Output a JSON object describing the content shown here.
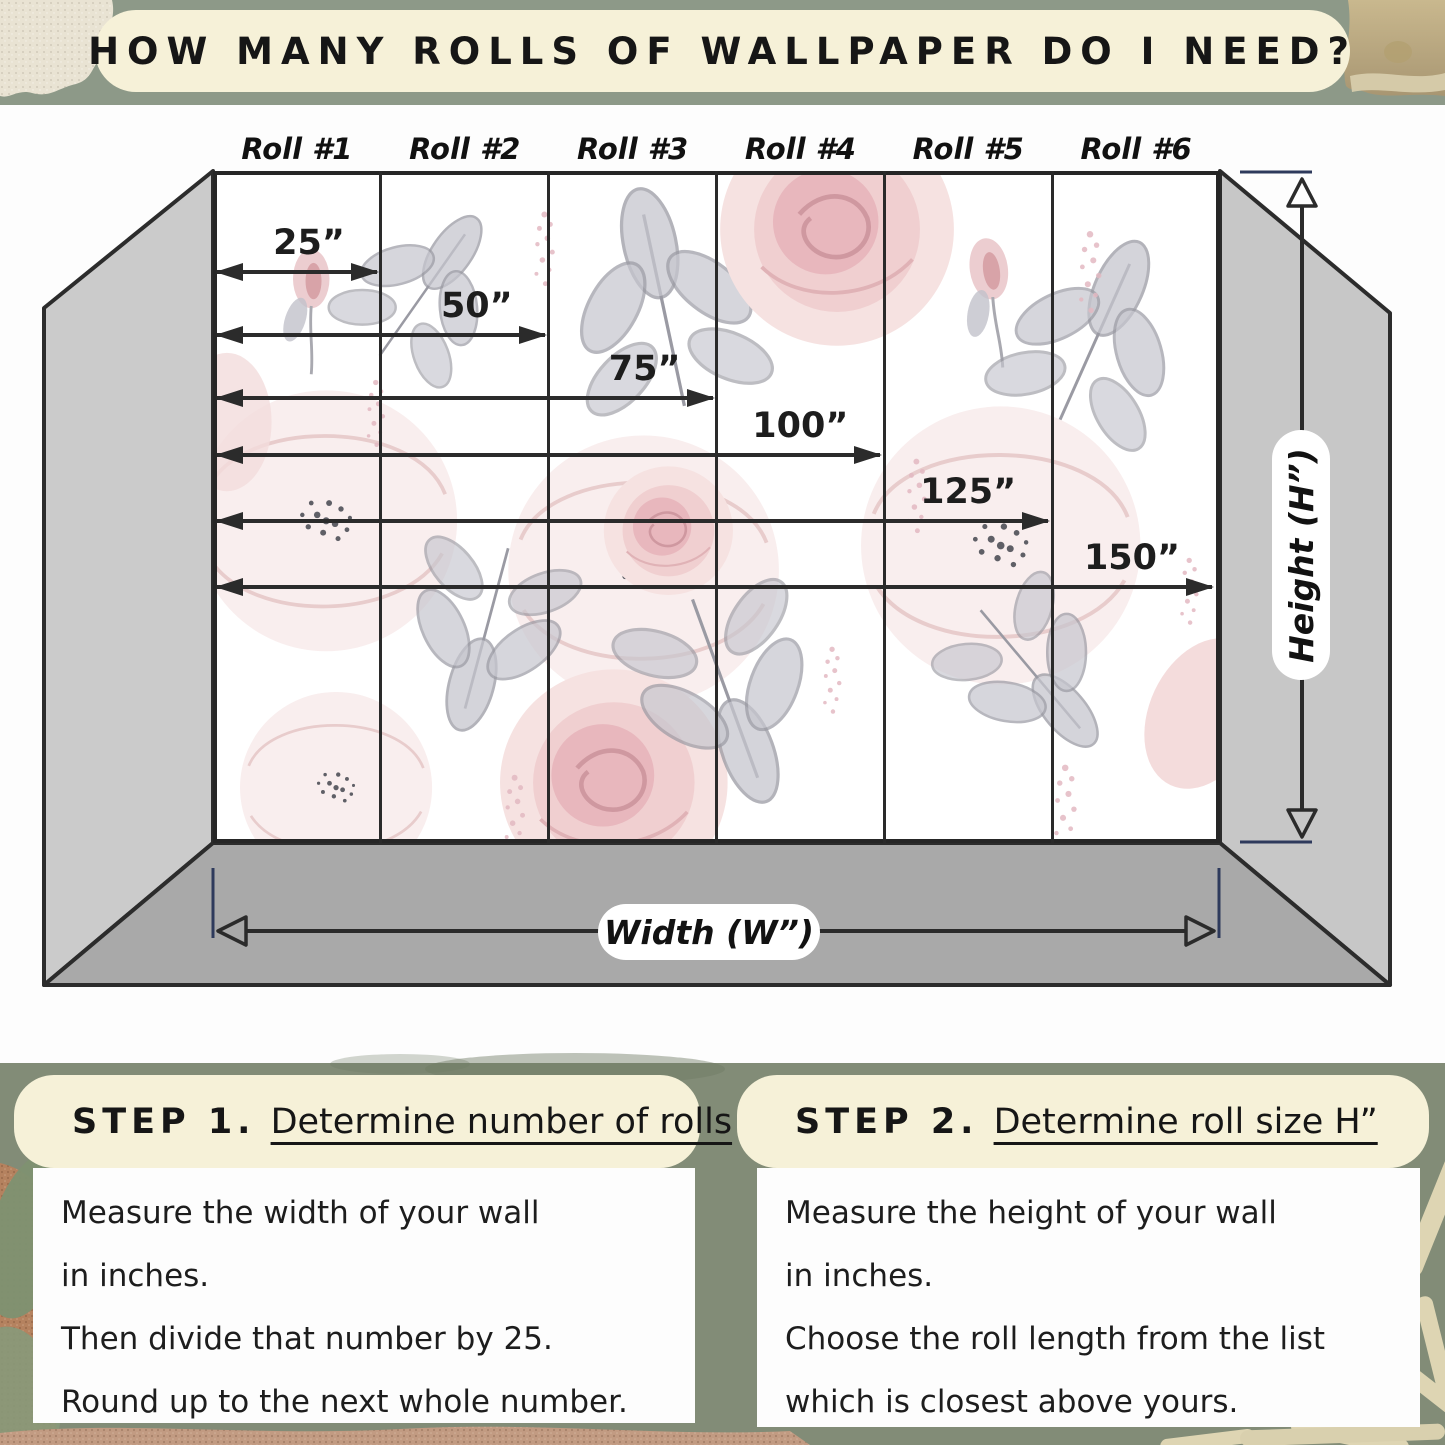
{
  "title": "HOW MANY ROLLS OF WALLPAPER DO I NEED?",
  "diagram": {
    "rolls": [
      "Roll #1",
      "Roll #2",
      "Roll #3",
      "Roll #4",
      "Roll #5",
      "Roll #6"
    ],
    "measurements": [
      {
        "label": "25”",
        "rolls": 1
      },
      {
        "label": "50”",
        "rolls": 2
      },
      {
        "label": "75”",
        "rolls": 3
      },
      {
        "label": "100”",
        "rolls": 4
      },
      {
        "label": "125”",
        "rolls": 5
      },
      {
        "label": "150”",
        "rolls": 6
      }
    ],
    "width_label": "Width (W”)",
    "height_label": "Height (H”)"
  },
  "steps": [
    {
      "prefix": "STEP 1.",
      "title": "Determine number of rolls",
      "lines": [
        "Measure the width of your wall",
        "in inches.",
        "Then divide that number by 25.",
        "Round up to the next whole number."
      ]
    },
    {
      "prefix": "STEP 2.",
      "title": "Determine roll size H”",
      "lines": [
        "Measure the height of your wall",
        "in inches.",
        "Choose the roll length from the list",
        "which is closest above yours."
      ]
    }
  ],
  "colors": {
    "sage_top": "#8d9988",
    "sage_bottom": "#828c77",
    "cream": "#f6f1d8",
    "outline": "#262626",
    "floor_gray": "#a9a9a9",
    "side_wall_gray": "#cbcbcb",
    "tick_navy": "#2e3a5c",
    "terracotta": "#b5825f",
    "sand": "#c29b82",
    "tan": "#bfae86",
    "beige": "#e9e3d3",
    "palm_beige": "#ded5b3",
    "leaf_green": "#7e9171",
    "rose_pink": "#e8b7bd",
    "leaf_gray": "#a8a8b0"
  }
}
